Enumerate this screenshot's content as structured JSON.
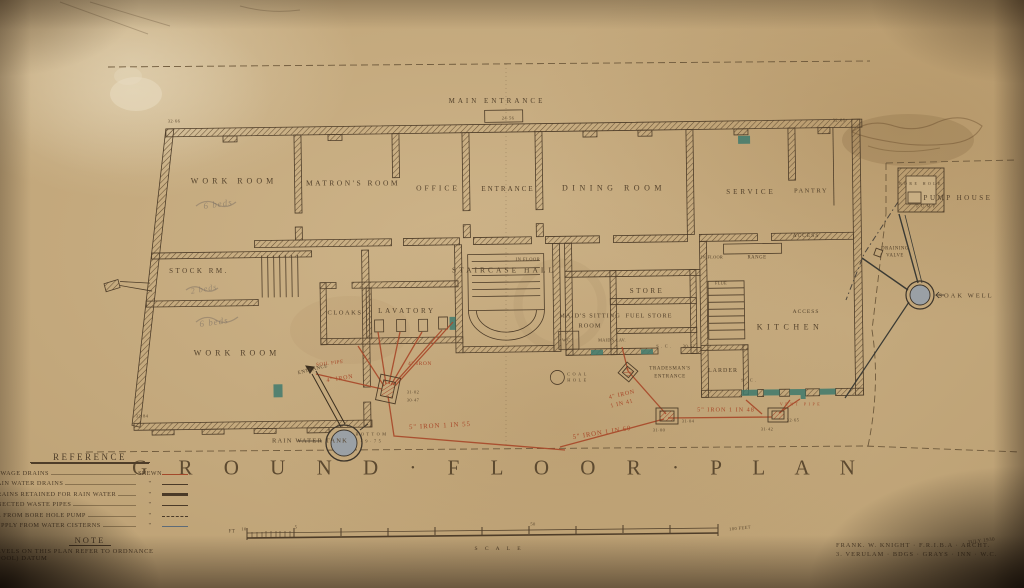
{
  "title": "G R O U N D · F L O O R · P L A N",
  "plan_labels": {
    "main_entrance": "MAIN ENTRANCE",
    "work_room_upper": "WORK ROOM",
    "matrons_room": "MATRON'S ROOM",
    "office": "OFFICE",
    "entrance": "ENTRANCE",
    "dining_room": "DINING ROOM",
    "service": "SERVICE",
    "pantry": "PANTRY",
    "access_service": "ACCESS",
    "stock_rm": "STOCK RM.",
    "work_room_lower": "WORK ROOM",
    "cloaks": "CLOAKS",
    "lavatory": "LAVATORY",
    "staircase_hall": "STAIRCASE HALL",
    "in_floor_hall": "IN FLOOR",
    "store": "STORE",
    "maids_sitting_1": "MAID'S SITTING",
    "maids_sitting_2": "ROOM",
    "fuel_store": "FUEL STORE",
    "wc": "W.C.",
    "maids_lav": "MAID'S LAV.",
    "kitchen": "KITCHEN",
    "access_kitchen": "ACCESS",
    "larder": "LARDER",
    "range": "RANGE",
    "in_floor_kitchen": "IN FLOOR",
    "flue": "FLUE",
    "sc1": "S.C.",
    "sc2": "S.C.",
    "tradesmans_1": "TRADESMAN'S",
    "tradesmans_2": "ENTRANCE",
    "coal_1": "COAL",
    "coal_2": "HOLE",
    "side_entrance": "ENTRANCE",
    "pump_house": "PUMP HOUSE",
    "bore_hole": "BORE HOLE",
    "pump": "PUMP",
    "draining_1": "DRAINING",
    "draining_2": "VALVE",
    "soak_well": "SOAK WELL",
    "rain_water_tank": "RAIN WATER TANK",
    "tank_bottom_1": "BOTTOM",
    "tank_bottom_2": "49·75"
  },
  "levels": {
    "entrance_step": "24·56",
    "nw_corner": "32·66",
    "ne_corner": "32·68",
    "sw_corner": "32·84",
    "mh1_a": "31·02",
    "mh1_b": "30·47",
    "mh2": "30·52",
    "mh3_a": "31·04",
    "mh3_b": "31·00",
    "mh4_a": "32·65",
    "mh4_b": "31·42"
  },
  "drain_labels": {
    "soil_pipe": "SOIL PIPE",
    "iron4_a": "4\" IRON",
    "iron4_b": "4\" IRON",
    "iron5_55": "5\" IRON 1 IN 55",
    "iron4_41_1": "4\" IRON",
    "iron4_41_2": "1 IN 41",
    "iron5_60": "5\" IRON 1 IN 60",
    "iron5_48": "5\" IRON 1 IN 48",
    "vent_pipe": "VENT PIPE"
  },
  "pencil_notes": {
    "n1": "6 beds",
    "n2": "6 beds",
    "n3": "2 beds"
  },
  "reference": {
    "title": "REFERENCE",
    "shewn": "SHEWN",
    "ditto": "\"",
    "rows": [
      {
        "label": "SEWAGE DRAINS"
      },
      {
        "label": "RAIN WATER DRAINS"
      },
      {
        "label": "DRAINS RETAINED FOR RAIN WATER"
      },
      {
        "label": "NNECTED WASTE PIPES"
      },
      {
        "label": "CE FROM BORE HOLE PUMP"
      },
      {
        "label": "SUPPLY FROM WATER CISTERNS"
      }
    ]
  },
  "note": {
    "title": "NOTE",
    "line1": "LEVELS ON THIS PLAN REFER TO ORDNANCE",
    "line2": "RPOOL)  DATUM"
  },
  "scale": {
    "ft": "FT",
    "ten": "10",
    "five": "5",
    "fifty": "50",
    "hundred": "100 FEET",
    "caption": "S C A L E"
  },
  "signature": {
    "line1": "FRANK. W. KNIGHT · F.R.I.B.A · ARCHT.",
    "line2": "3. VERULAM · BDGS · GRAYS · INN · W.C.",
    "date": "JULY 1930"
  },
  "colors": {
    "ink": "#4e3d29",
    "red": "#a8492a",
    "teal": "#3f7a6d",
    "paper": "#c4aa7f",
    "water_grey": "#9aa0a5"
  }
}
